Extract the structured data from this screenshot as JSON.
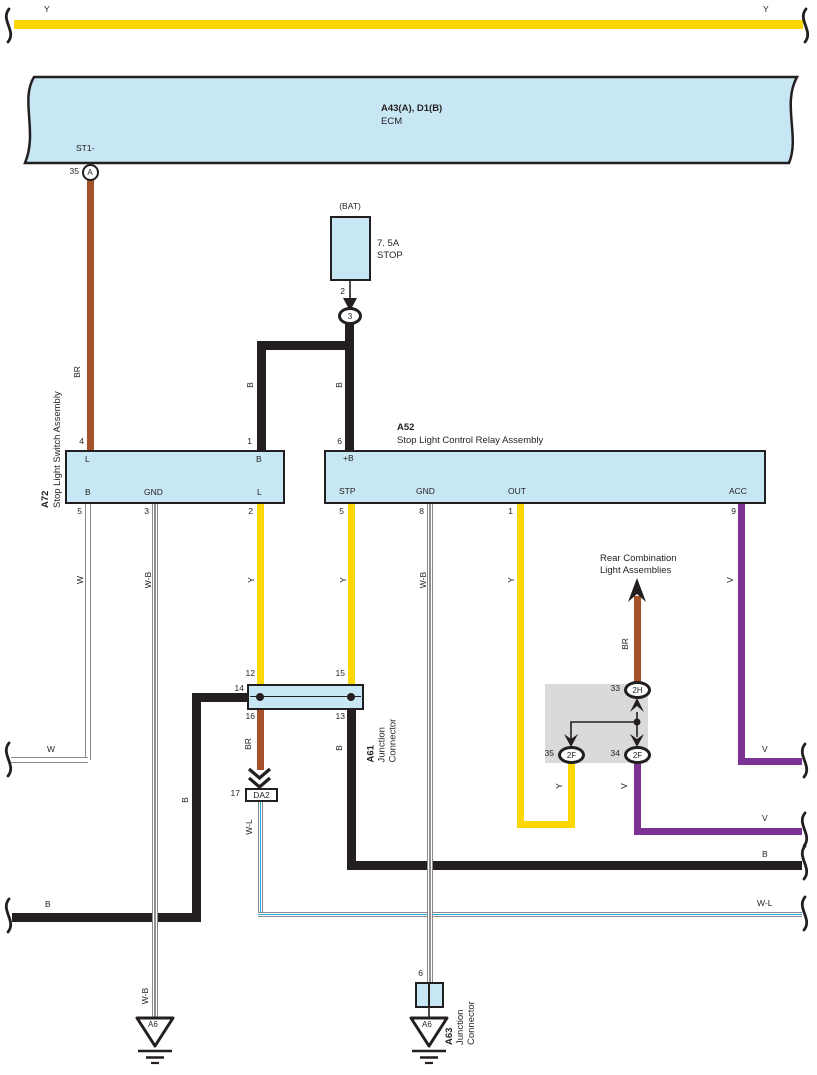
{
  "colors": {
    "yellow": "#FBD703",
    "brown": "#A5522B",
    "purple": "#7B3294",
    "lightblue": "#C8E7F5",
    "blue_stripe": "#29ABE2",
    "graybox": "#DADADA",
    "ink": "#231F20",
    "wire_edge": "#8A8A8A"
  },
  "top_wire": {
    "left_label": "Y",
    "right_label": "Y"
  },
  "ecm": {
    "code": "A43(A), D1(B)",
    "name": "ECM",
    "terminal": "ST1-",
    "pin": "35",
    "conn": "A",
    "pin4": "4",
    "wire_label": "BR"
  },
  "fuse": {
    "bus": "(BAT)",
    "rating": "7. 5A",
    "name": "STOP",
    "pin": "2",
    "node": "3",
    "wire_left": "B",
    "wire_right": "B",
    "pin_left": "1",
    "pin_right": "6"
  },
  "a72": {
    "code": "A72",
    "name": "Stop Light Switch Assembly",
    "t_l_top": "L",
    "t_b_top": "B",
    "t_b": "B",
    "t_gnd": "GND",
    "t_l": "L",
    "p5": "5",
    "p3": "3",
    "p2": "2"
  },
  "a52": {
    "code": "A52",
    "name": "Stop Light Control Relay Assembly",
    "t_pb": "+B",
    "t_stp": "STP",
    "t_gnd": "GND",
    "t_out": "OUT",
    "t_acc": "ACC",
    "p5": "5",
    "p8": "8",
    "p1": "1",
    "p9": "9"
  },
  "wires": {
    "w_v": "W",
    "w_h": "W",
    "wb_left_v": "W-B",
    "wb_left_gnd": "W-B",
    "y_a72": "Y",
    "y_stp": "Y",
    "wb_gnd": "W-B",
    "y_out": "Y",
    "v_acc": "V",
    "v_acc_h": "V",
    "b_left_v": "B",
    "b_left_h": "B",
    "br_down": "BR",
    "wl_v": "W-L",
    "wl_h": "W-L",
    "b_right_v": "B",
    "b_right_h": "B",
    "y_up": "Y",
    "v_down": "V",
    "v_down_h": "V",
    "br_up": "BR"
  },
  "a61": {
    "code": "A61",
    "name1": "Junction",
    "name2": "Connector",
    "p12": "12",
    "p15": "15",
    "p14": "14",
    "p16": "16",
    "p13": "13"
  },
  "da2": {
    "pin": "17",
    "label": "DA2"
  },
  "rear": {
    "title1": "Rear Combination",
    "title2": "Light Assemblies",
    "c2h": "2H",
    "p33": "33",
    "c2f_l": "2F",
    "p35": "35",
    "c2f_r": "2F",
    "p34": "34"
  },
  "a63": {
    "code": "A63",
    "name1": "Junction",
    "name2": "Connector",
    "pin": "6"
  },
  "grounds": {
    "left": "A6",
    "right": "A6"
  }
}
